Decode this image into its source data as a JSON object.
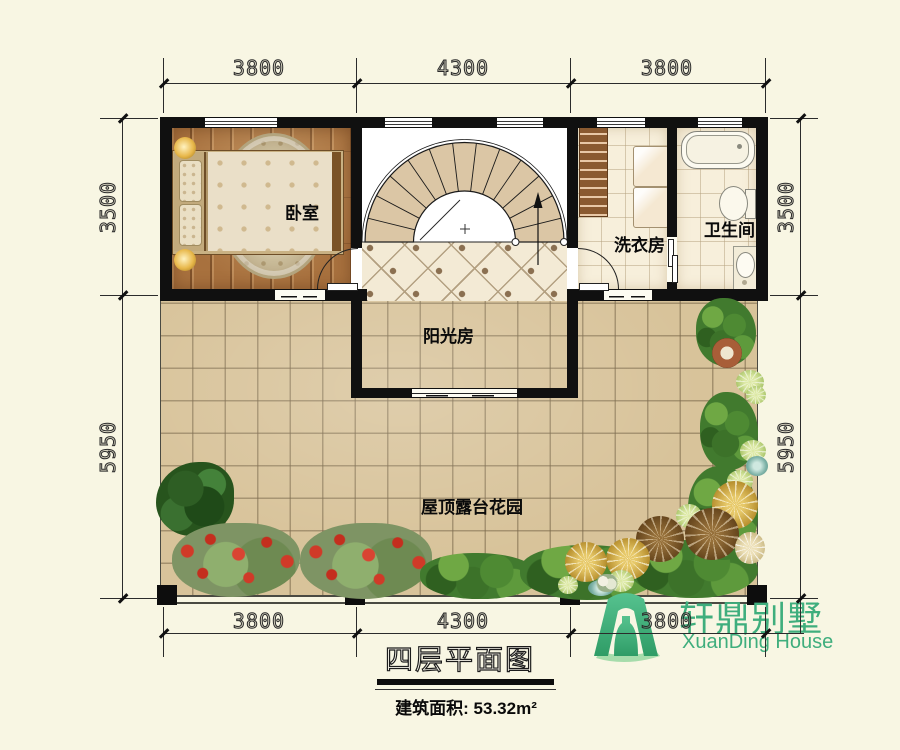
{
  "plan": {
    "rooms": [
      {
        "id": "bedroom",
        "label": "卧室"
      },
      {
        "id": "sunroom",
        "label": "阳光房"
      },
      {
        "id": "laundry",
        "label": "洗衣房"
      },
      {
        "id": "bathroom",
        "label": "卫生间"
      },
      {
        "id": "terrace",
        "label": "屋顶露台花园"
      }
    ]
  },
  "dimensions": {
    "top": [
      "3800",
      "4300",
      "3800"
    ],
    "bottom": [
      "3800",
      "4300",
      "3800"
    ],
    "left": [
      "3500",
      "5950"
    ],
    "right": [
      "3500",
      "5950"
    ]
  },
  "title_block": {
    "floor_title": "四层平面图",
    "area_label": "建筑面积:",
    "area_value": "53.32m²"
  },
  "logo": {
    "name_cn": "轩鼎别墅",
    "name_en": "XuanDing House",
    "color": "#3fae7d"
  },
  "colors": {
    "background": "#f8f6e3",
    "wall": "#101010",
    "wood_floor": "#a8713e",
    "terrace_tile": "#d8c39a",
    "sunroom_tile": "#f3ead5",
    "bath_tile": "#f7efdb",
    "stair_tread": "#dbc6a5",
    "logo_green": "#3fae7d"
  }
}
